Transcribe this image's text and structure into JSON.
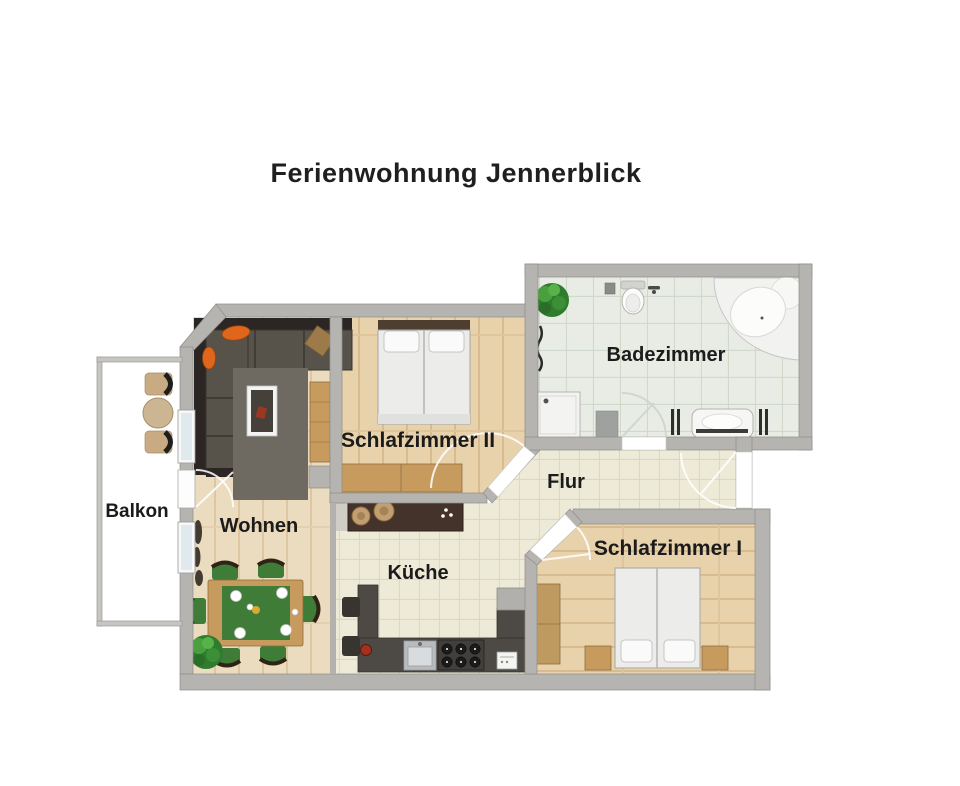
{
  "title": "Ferienwohnung Jennerblick",
  "rooms": {
    "balkon": {
      "label": "Balkon"
    },
    "wohnen": {
      "label": "Wohnen"
    },
    "schlafzimmer_2": {
      "label": "Schlafzimmer II"
    },
    "badezimmer": {
      "label": "Badezimmer"
    },
    "flur": {
      "label": "Flur"
    },
    "kueche": {
      "label": "Küche"
    },
    "schlafzimmer_1": {
      "label": "Schlafzimmer I"
    }
  },
  "colors": {
    "wall": "#b5b4b0",
    "wood_living": "#ebdcbf",
    "wood_bedroom": "#e8d2ac",
    "tile_kitchen": "#eeead8",
    "tile_bath": "#e9ece4",
    "sofa": "#57524a",
    "accent_orange": "#e0661c",
    "dining_green": "#3e7c38",
    "counter_dark": "#4d4a45",
    "bar_counter": "#44332a",
    "furniture_wood": "#c79b5e",
    "plant_green": "#3f8f3f"
  }
}
